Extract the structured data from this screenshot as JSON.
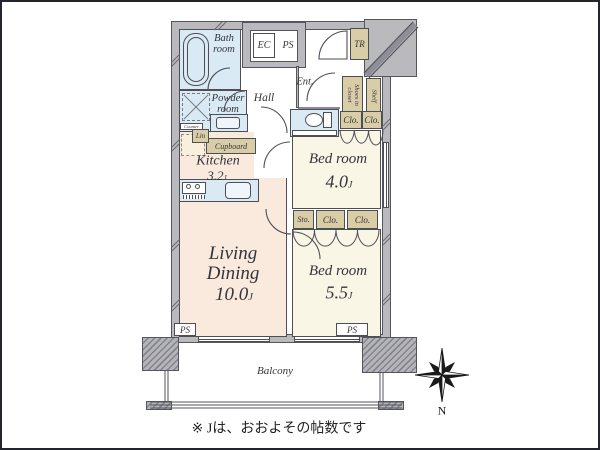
{
  "labels": {
    "bath": "Bath room",
    "powder": "Powder room",
    "hall": "Hall",
    "ent": "Ent.",
    "ec": "EC",
    "ps": "PS",
    "tr": "TR",
    "shoes": "Shoes in closet",
    "shelf": "Shelf",
    "counter": "Counter",
    "lin": "Lin",
    "cupboard": "Cupboard",
    "sto": "Sto.",
    "clo": "Clo.",
    "balcony": "Balcony",
    "north": "N",
    "unit_suffix": "J",
    "note": "※ Jは、おおよその帖数です"
  },
  "rooms": {
    "kitchen": {
      "name": "Kitchen",
      "size": "3.2"
    },
    "bedroom_upper": {
      "name": "Bed room",
      "size": "4.0"
    },
    "bedroom_lower": {
      "name": "Bed room",
      "size": "5.5"
    },
    "living": {
      "line1": "Living",
      "line2": "Dining",
      "size": "10.0"
    }
  },
  "colors": {
    "wall_gray": "#b9b9be",
    "line_dark": "#4e4e55",
    "water_blue": "#d9eaf5",
    "warm_peach": "#faeadd",
    "room_cream": "#faf6e6",
    "closet_beige": "#d9cda7",
    "text": "#34343a"
  }
}
